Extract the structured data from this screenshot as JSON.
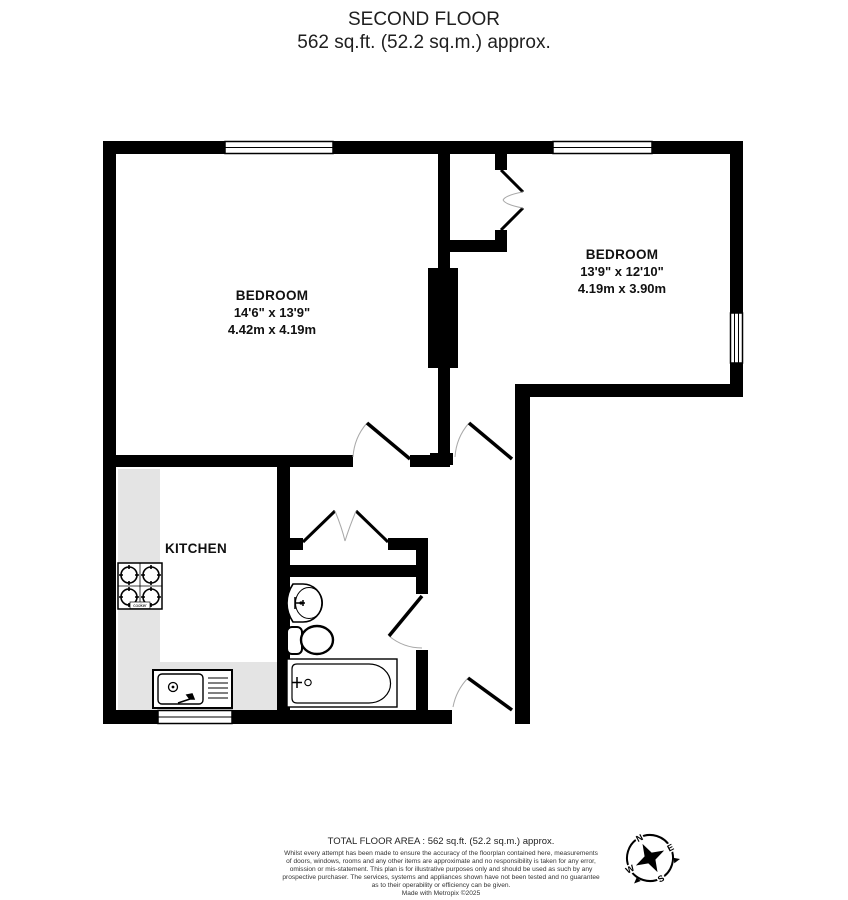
{
  "title": {
    "line1": "SECOND FLOOR",
    "line2": "562 sq.ft. (52.2 sq.m.) approx."
  },
  "rooms": {
    "bedroom_left": {
      "name": "BEDROOM",
      "imperial": "14'6\" x 13'9\"",
      "metric": "4.42m x 4.19m"
    },
    "bedroom_right": {
      "name": "BEDROOM",
      "imperial": "13'9\" x 12'10\"",
      "metric": "4.19m x 3.90m"
    },
    "kitchen": {
      "name": "KITCHEN"
    }
  },
  "fixtures": {
    "cooker_label": "cooker"
  },
  "compass": {
    "n": "N",
    "e": "E",
    "s": "S",
    "w": "W"
  },
  "footer": {
    "total_area": "TOTAL FLOOR AREA : 562 sq.ft. (52.2 sq.m.) approx.",
    "disclaimer_lines": [
      "Whilst every attempt has been made to ensure the accuracy of the floorplan contained here, measurements",
      "of doors, windows, rooms and any other items are approximate and no responsibility is taken for any error,",
      "omission or mis-statement. This plan is for illustrative purposes only and should be used as such by any",
      "prospective purchaser. The services, systems and appliances shown have not been tested and no guarantee",
      "as to their operability or efficiency can be given.",
      "Made with Metropix ©2025"
    ]
  },
  "colors": {
    "wall": "#000000",
    "worktop": "#e4e4e4",
    "window": "#ffffff",
    "door_arc": "#a8a8a8"
  }
}
